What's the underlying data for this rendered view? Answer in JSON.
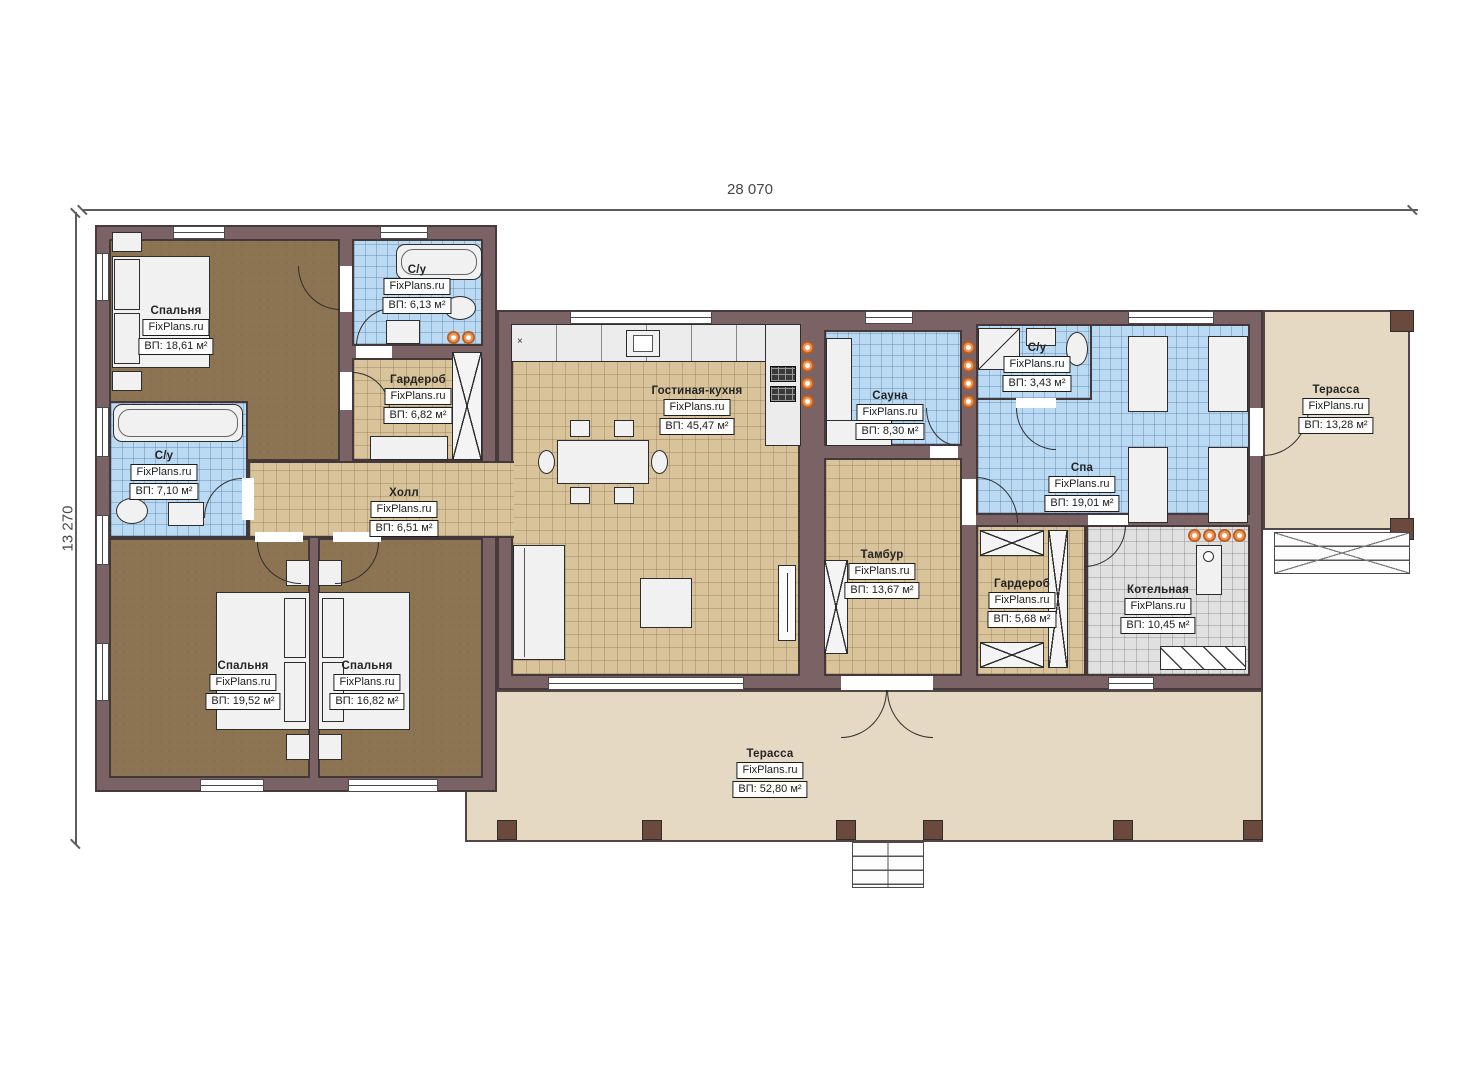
{
  "dims": {
    "width": "28 070",
    "height": "13 270"
  },
  "misc": {
    "counter_marker": "×"
  },
  "rooms": [
    {
      "name": "Спальня",
      "brand": "FixPlans.ru",
      "area": "ВП: 18,61 м²"
    },
    {
      "name": "С/у",
      "brand": "FixPlans.ru",
      "area": "ВП: 6,13 м²"
    },
    {
      "name": "Гардероб",
      "brand": "FixPlans.ru",
      "area": "ВП: 6,82 м²"
    },
    {
      "name": "С/у",
      "brand": "FixPlans.ru",
      "area": "ВП: 7,10 м²"
    },
    {
      "name": "Холл",
      "brand": "FixPlans.ru",
      "area": "ВП: 6,51 м²"
    },
    {
      "name": "Спальня",
      "brand": "FixPlans.ru",
      "area": "ВП: 19,52 м²"
    },
    {
      "name": "Спальня",
      "brand": "FixPlans.ru",
      "area": "ВП: 16,82 м²"
    },
    {
      "name": "Гостиная-кухня",
      "brand": "FixPlans.ru",
      "area": "ВП: 45,47 м²"
    },
    {
      "name": "Сауна",
      "brand": "FixPlans.ru",
      "area": "ВП: 8,30 м²"
    },
    {
      "name": "С/у",
      "brand": "FixPlans.ru",
      "area": "ВП: 3,43 м²"
    },
    {
      "name": "Спа",
      "brand": "FixPlans.ru",
      "area": "ВП: 19,01 м²"
    },
    {
      "name": "Тамбур",
      "brand": "FixPlans.ru",
      "area": "ВП: 13,67 м²"
    },
    {
      "name": "Гардероб",
      "brand": "FixPlans.ru",
      "area": "ВП: 5,68 м²"
    },
    {
      "name": "Котельная",
      "brand": "FixPlans.ru",
      "area": "ВП: 10,45 м²"
    },
    {
      "name": "Терасса",
      "brand": "FixPlans.ru",
      "area": "ВП: 13,28 м²"
    },
    {
      "name": "Терасса",
      "brand": "FixPlans.ru",
      "area": "ВП: 52,80 м²"
    }
  ],
  "colors": {
    "wall": "#7b6365",
    "floor_bedroom": "#8c7352",
    "floor_tile_tan": "#d8c39b",
    "floor_tile_blue": "#bad9f2",
    "floor_tile_gray": "#e0e0e0",
    "terrace": "#e6d9c3",
    "accent_light_dot": "#f09050",
    "dimension_text": "#474747"
  }
}
